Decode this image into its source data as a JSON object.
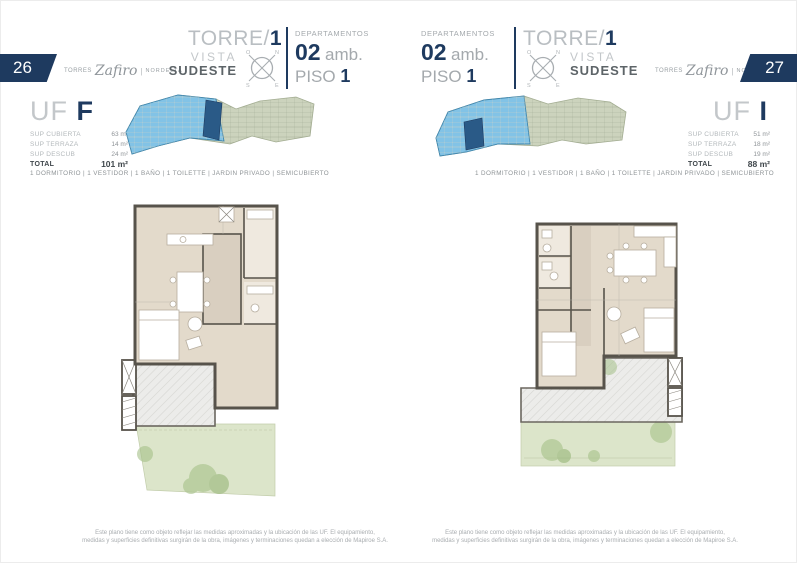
{
  "left": {
    "page_number": "26",
    "brand": {
      "prefix": "Torres",
      "script": "Zafiro",
      "divider": "|",
      "suffix": "NORDELTA"
    },
    "title": {
      "tower": "TORRE/",
      "tower_num": "1",
      "vista": "VISTA",
      "orientation": "SUDESTE"
    },
    "dept": {
      "label": "DEPARTAMENTOS",
      "units": "02",
      "units_suffix": "amb.",
      "floor_label": "PISO",
      "floor_num": "1"
    },
    "unit": {
      "uf_label": "UF",
      "uf_letter": "F"
    },
    "surfaces": [
      {
        "label": "SUP CUBIERTA",
        "value": "63 m²"
      },
      {
        "label": "SUP TERRAZA",
        "value": "14 m²"
      },
      {
        "label": "SUP DESCUB",
        "value": "24 m²"
      },
      {
        "label": "TOTAL",
        "value": "101 m²"
      }
    ],
    "amenities": "1 DORMITORIO | 1 VESTIDOR | 1 BAÑO | 1 TOILETTE | JARDIN PRIVADO | SEMICUBIERTO",
    "disclaimer_line1": "Este plano tiene como objeto reflejar las medidas aproximadas y la ubicación de las UF. El equipamiento,",
    "disclaimer_line2": "medidas y superficies definitivas surgirán de la obra, imágenes y terminaciones quedan a elección de Mapiroe S.A."
  },
  "right": {
    "page_number": "27",
    "brand": {
      "prefix": "Torres",
      "script": "Zafiro",
      "divider": "|",
      "suffix": "NORDELTA"
    },
    "title": {
      "tower": "TORRE/",
      "tower_num": "1",
      "vista": "VISTA",
      "orientation": "SUDESTE"
    },
    "dept": {
      "label": "DEPARTAMENTOS",
      "units": "02",
      "units_suffix": "amb.",
      "floor_label": "PISO",
      "floor_num": "1"
    },
    "unit": {
      "uf_label": "UF",
      "uf_letter": "I"
    },
    "surfaces": [
      {
        "label": "SUP CUBIERTA",
        "value": "51 m²"
      },
      {
        "label": "SUP TERRAZA",
        "value": "18 m²"
      },
      {
        "label": "SUP DESCUB",
        "value": "19 m²"
      },
      {
        "label": "TOTAL",
        "value": "88 m²"
      }
    ],
    "amenities": "1 DORMITORIO | 1 VESTIDOR | 1 BAÑO | 1 TOILETTE | JARDIN PRIVADO | SEMICUBIERTO",
    "disclaimer_line1": "Este plano tiene como objeto reflejar las medidas aproximadas y la ubicación de las UF. El equipamiento,",
    "disclaimer_line2": "medidas y superficies definitivas surgirán de la obra, imágenes y terminaciones quedan a elección de Mapiroe S.A."
  },
  "compass": {
    "n": "N",
    "s": "S",
    "e": "E",
    "o": "O"
  },
  "colors": {
    "navy": "#1e3a5f",
    "tower_highlight_blue": "#82c3e6",
    "unit_highlight_dark_blue": "#2a5a87",
    "plan_floor_beige": "#e3dacb",
    "garden_green": "#dce5ca",
    "wall_gray": "#57534b"
  }
}
